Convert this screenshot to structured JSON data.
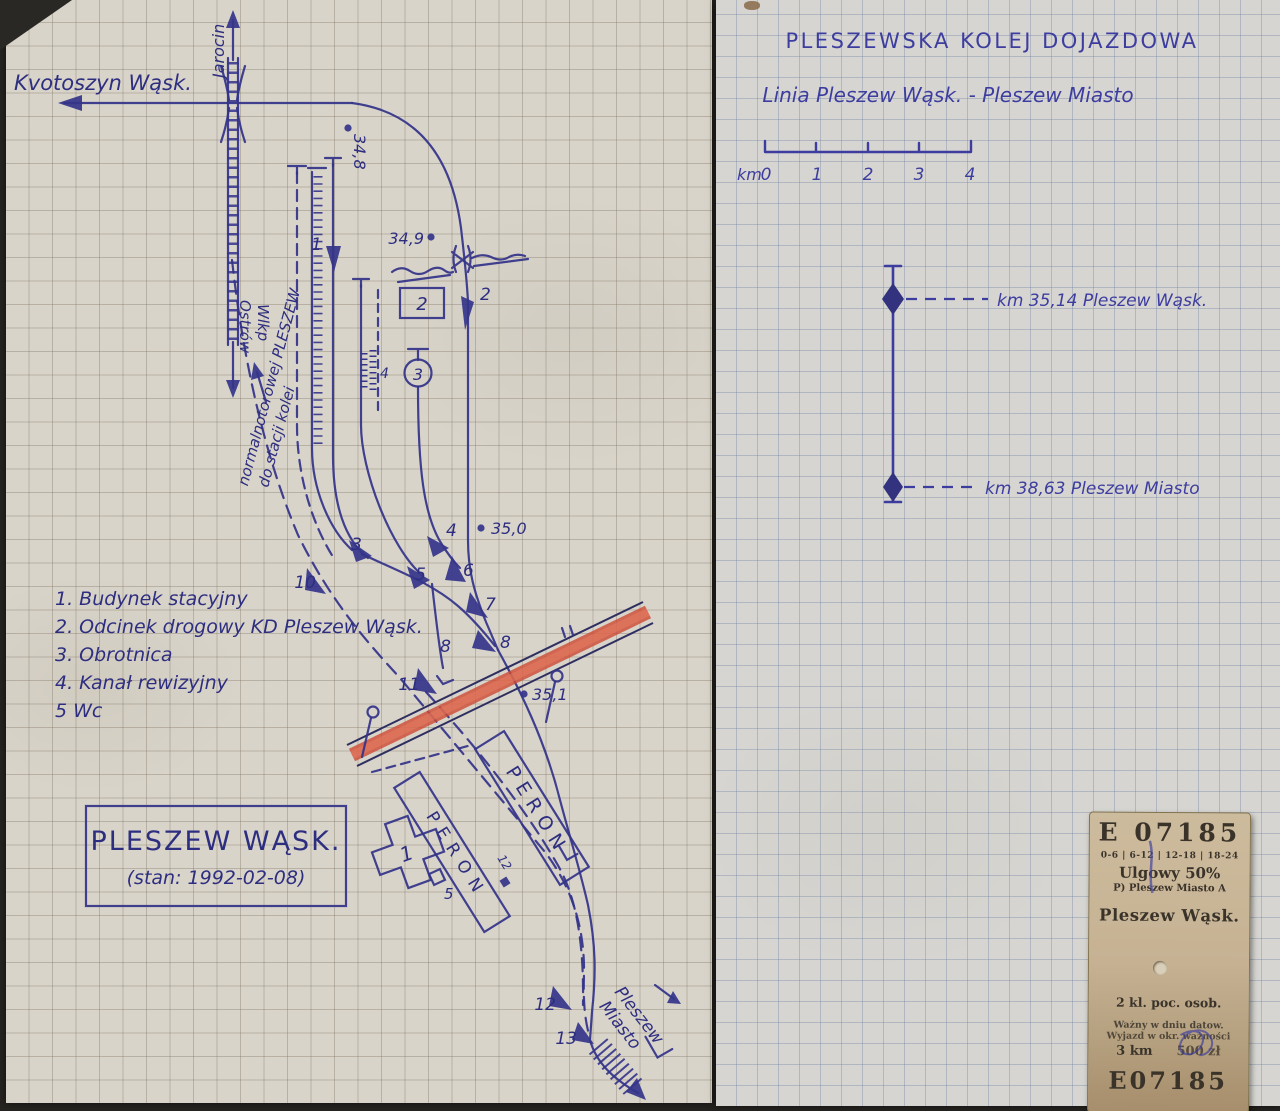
{
  "left_page": {
    "edge_labels": {
      "krotoszyn": "Kvotoszyn Wąsk.",
      "jarocin": "Jarocin",
      "ostrow_1": "Ostrów",
      "ostrow_2": "Wlkp",
      "to_normal_gauge_1": "do stacji kolei",
      "to_normal_gauge_2": "normalnotorowej PLESZEW",
      "pleszew_miasto_1": "Pleszew",
      "pleszew_miasto_2": "Miasto"
    },
    "km_posts": {
      "p348": "34,8",
      "p349": "34,9",
      "p350": "35,0",
      "p351": "35,1"
    },
    "structures": {
      "station_building": "1",
      "road_box": "2",
      "turntable": "3",
      "pit": "4",
      "wc": "5",
      "peron": "PERON",
      "signal": "12"
    },
    "switch_labels": [
      "1",
      "2",
      "3",
      "4",
      "5",
      "6",
      "7",
      "8",
      "10",
      "11",
      "12",
      "13"
    ],
    "track_labels": {
      "t8": "8"
    },
    "legend": [
      "1. Budynek stacyjny",
      "2. Odcinek drogowy KD Pleszew Wąsk.",
      "3. Obrotnica",
      "4. Kanał rewizyjny",
      "5  Wc"
    ],
    "station_box": {
      "name": "PLESZEW WĄSK.",
      "state": "(stan: 1992-02-08)"
    }
  },
  "right_page": {
    "title": "PLESZEWSKA  KOLEJ  DOJAZDOWA",
    "subtitle": "Linia  Pleszew  Wąsk.  -  Pleszew  Miasto",
    "scale": {
      "unit": "km",
      "ticks": [
        "0",
        "1",
        "2",
        "3",
        "4"
      ]
    },
    "stations": [
      "km 35,14  Pleszew Wąsk.",
      "km 38,63  Pleszew Miasto"
    ]
  },
  "ticket": {
    "serial_top": "E 07185",
    "time_bands": "0-6 | 6-12 | 12-18 | 18-24",
    "discount": "Ulgowy 50%",
    "from_line": "P) Pleszew Miasto A",
    "station": "Pleszew Wąsk.",
    "class_line": "2 kl. poc. osob.",
    "valid_line1": "Ważny w dniu datow.",
    "valid_line2": "Wyjazd w okr. ważności",
    "distance": "3 km",
    "price": "500 zł",
    "serial_bottom": "E07185"
  },
  "colors": {
    "ink_left": "#34348a",
    "ink_right": "#3d3da0",
    "road_red": "#cf4a35",
    "paper_left": "#d8d4ca",
    "paper_right": "#d6d5d1",
    "ticket_bg": "#c6b292"
  }
}
